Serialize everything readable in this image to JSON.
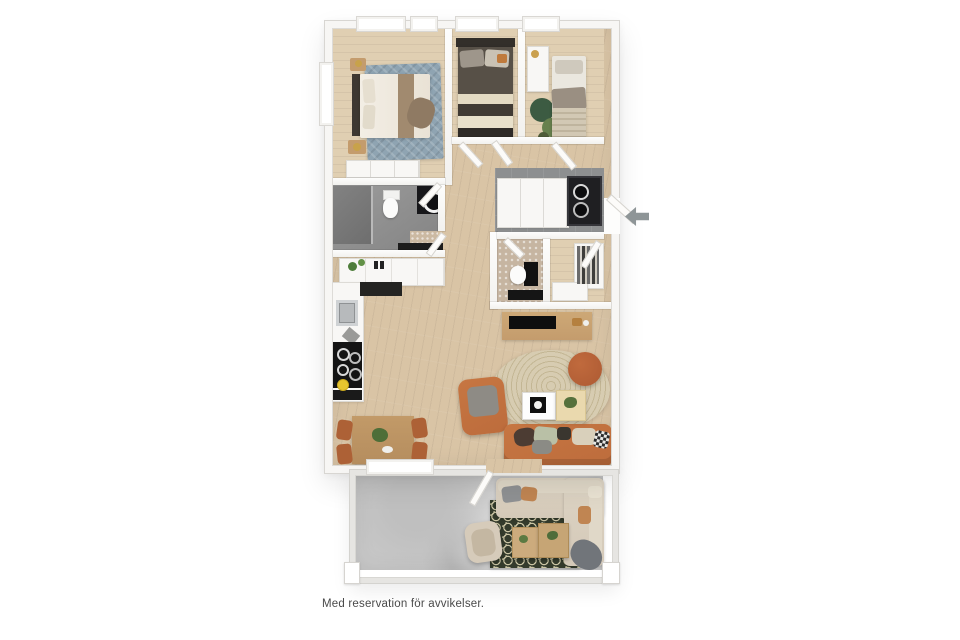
{
  "page": {
    "caption": "Med reservation för avvikelser.",
    "background": "#ffffff"
  },
  "icons": {
    "entrance_arrow": "left-arrow"
  },
  "plan": {
    "kind": "3D rendered apartment floor plan, top-down view",
    "rooms": [
      "bedroom-1",
      "bedroom-2",
      "bedroom-3",
      "bathroom",
      "hallway",
      "entry-hall",
      "wc",
      "walk-in-closet",
      "kitchen",
      "dining-area",
      "living-room",
      "balcony"
    ]
  },
  "palette": {
    "wood": "#d9c4a5",
    "wood-light": "#e0cfb2",
    "entry-floor": "#8d8f90",
    "wc-floor": "#c6b5a1",
    "concrete": "#c8c8c8",
    "rug-blue": "#8fa4b2",
    "rug-living": "#d7ccb1",
    "rug-living-line": "#c3b694",
    "rug-balcony": "#343b2c",
    "rug-balcony-dot": "#cbc5a4",
    "sofa": "#bd6c3c",
    "pouf": "#ad5a33",
    "wood-furn": "#c49c6d",
    "wood-table": "#b58d5e",
    "beige-sofa": "#d4c9b8",
    "arrow": "#8e9597",
    "caption": "#4a4a4a"
  }
}
